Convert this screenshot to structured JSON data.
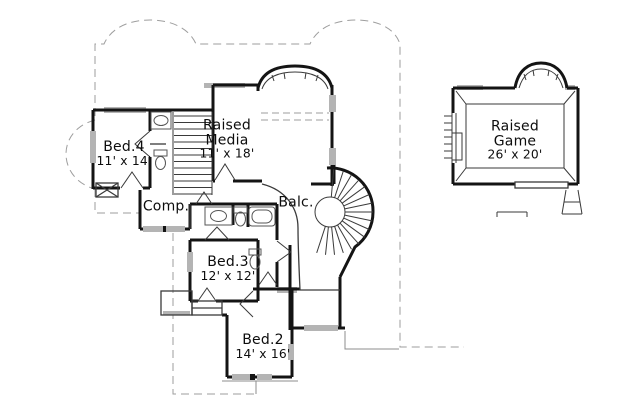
{
  "title": "Second floor plan",
  "colors": {
    "background": "#ffffff",
    "wall": "#141414",
    "thin_line": "#3a3a3a",
    "fixture": "#555555",
    "roof_dashed": "#9e9e9e",
    "window_fill": "#b4b4b4",
    "text": "#0d0d0d"
  },
  "rooms": [
    {
      "id": "bed4",
      "name": "Bed.4",
      "dims": "11' x 14'"
    },
    {
      "id": "media",
      "name": "Raised\nMedia",
      "dims": "11' x 18'"
    },
    {
      "id": "comp",
      "name": "Comp.",
      "dims": ""
    },
    {
      "id": "balc",
      "name": "Balc.",
      "dims": ""
    },
    {
      "id": "bed3",
      "name": "Bed.3",
      "dims": "12' x 12'"
    },
    {
      "id": "bed2",
      "name": "Bed.2",
      "dims": "14' x 16'"
    },
    {
      "id": "game",
      "name": "Raised\nGame",
      "dims": "26' x 20'"
    }
  ]
}
